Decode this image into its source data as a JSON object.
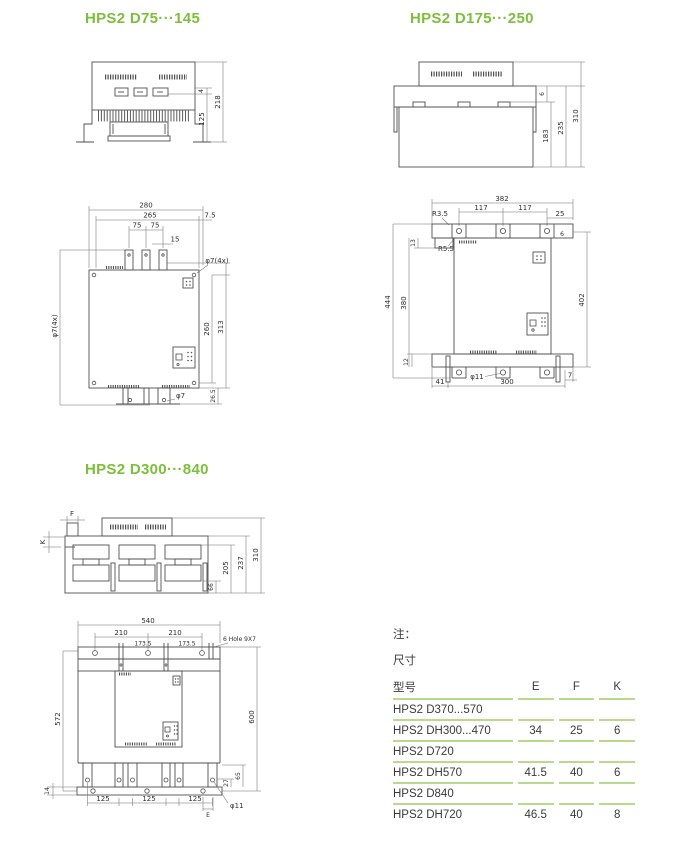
{
  "sections": {
    "s1": {
      "title": "HPS2 D75···145",
      "top": {
        "d218": "218",
        "d125": "125",
        "d4": "4"
      },
      "front": {
        "d280": "280",
        "d265": "265",
        "d75a": "75",
        "d75b": "75",
        "d15": "15",
        "d7_5": "7.5",
        "dphi7L": "φ7(4x)",
        "dphi7TR": "φ7(4x)",
        "d260": "260",
        "d313": "313",
        "d26_5": "26.5",
        "dphi7": "φ7"
      }
    },
    "s2": {
      "title": "HPS2 D175···250",
      "top": {
        "d310": "310",
        "d235": "235",
        "d183": "183",
        "d6": "6"
      },
      "front": {
        "d382": "382",
        "d117a": "117",
        "d117b": "117",
        "d25": "25",
        "r35": "R3.5",
        "r55": "R5.5",
        "d13": "13",
        "d444": "444",
        "d380": "380",
        "d402": "402",
        "d12": "12",
        "d41": "41",
        "d300": "300",
        "d7": "7",
        "dphi11": "φ11",
        "d6": "6"
      }
    },
    "s3": {
      "title": "HPS2 D300···840",
      "top": {
        "dF": "F",
        "dK": "K",
        "d310": "310",
        "d237": "237",
        "d205": "205",
        "d66": "66"
      },
      "front": {
        "d540": "540",
        "d210a": "210",
        "d210b": "210",
        "d1735a": "173.5",
        "d1735b": "173.5",
        "holes": "6 Hole 9X7",
        "d572": "572",
        "d600": "600",
        "d14": "14",
        "d125a": "125",
        "d125b": "125",
        "d125c": "125",
        "d27": "27",
        "d65": "65",
        "dphi11": "φ11",
        "dE": "E"
      }
    }
  },
  "table": {
    "note": "注：",
    "size_label": "尺寸",
    "headers": {
      "model": "型号",
      "e": "E",
      "f": "F",
      "k": "K"
    },
    "rows": [
      {
        "model": "HPS2 D370...570",
        "e": "",
        "f": "",
        "k": ""
      },
      {
        "model": "HPS2 DH300...470",
        "e": "34",
        "f": "25",
        "k": "6"
      },
      {
        "model": "HPS2 D720",
        "e": "",
        "f": "",
        "k": ""
      },
      {
        "model": "HPS2 DH570",
        "e": "41.5",
        "f": "40",
        "k": "6"
      },
      {
        "model": "HPS2 D840",
        "e": "",
        "f": "",
        "k": ""
      },
      {
        "model": "HPS2 DH720",
        "e": "46.5",
        "f": "40",
        "k": "8"
      }
    ]
  },
  "colors": {
    "accent_green": "#7cbf3a",
    "table_line": "#b9d98c",
    "ink": "#3a3a3a"
  }
}
